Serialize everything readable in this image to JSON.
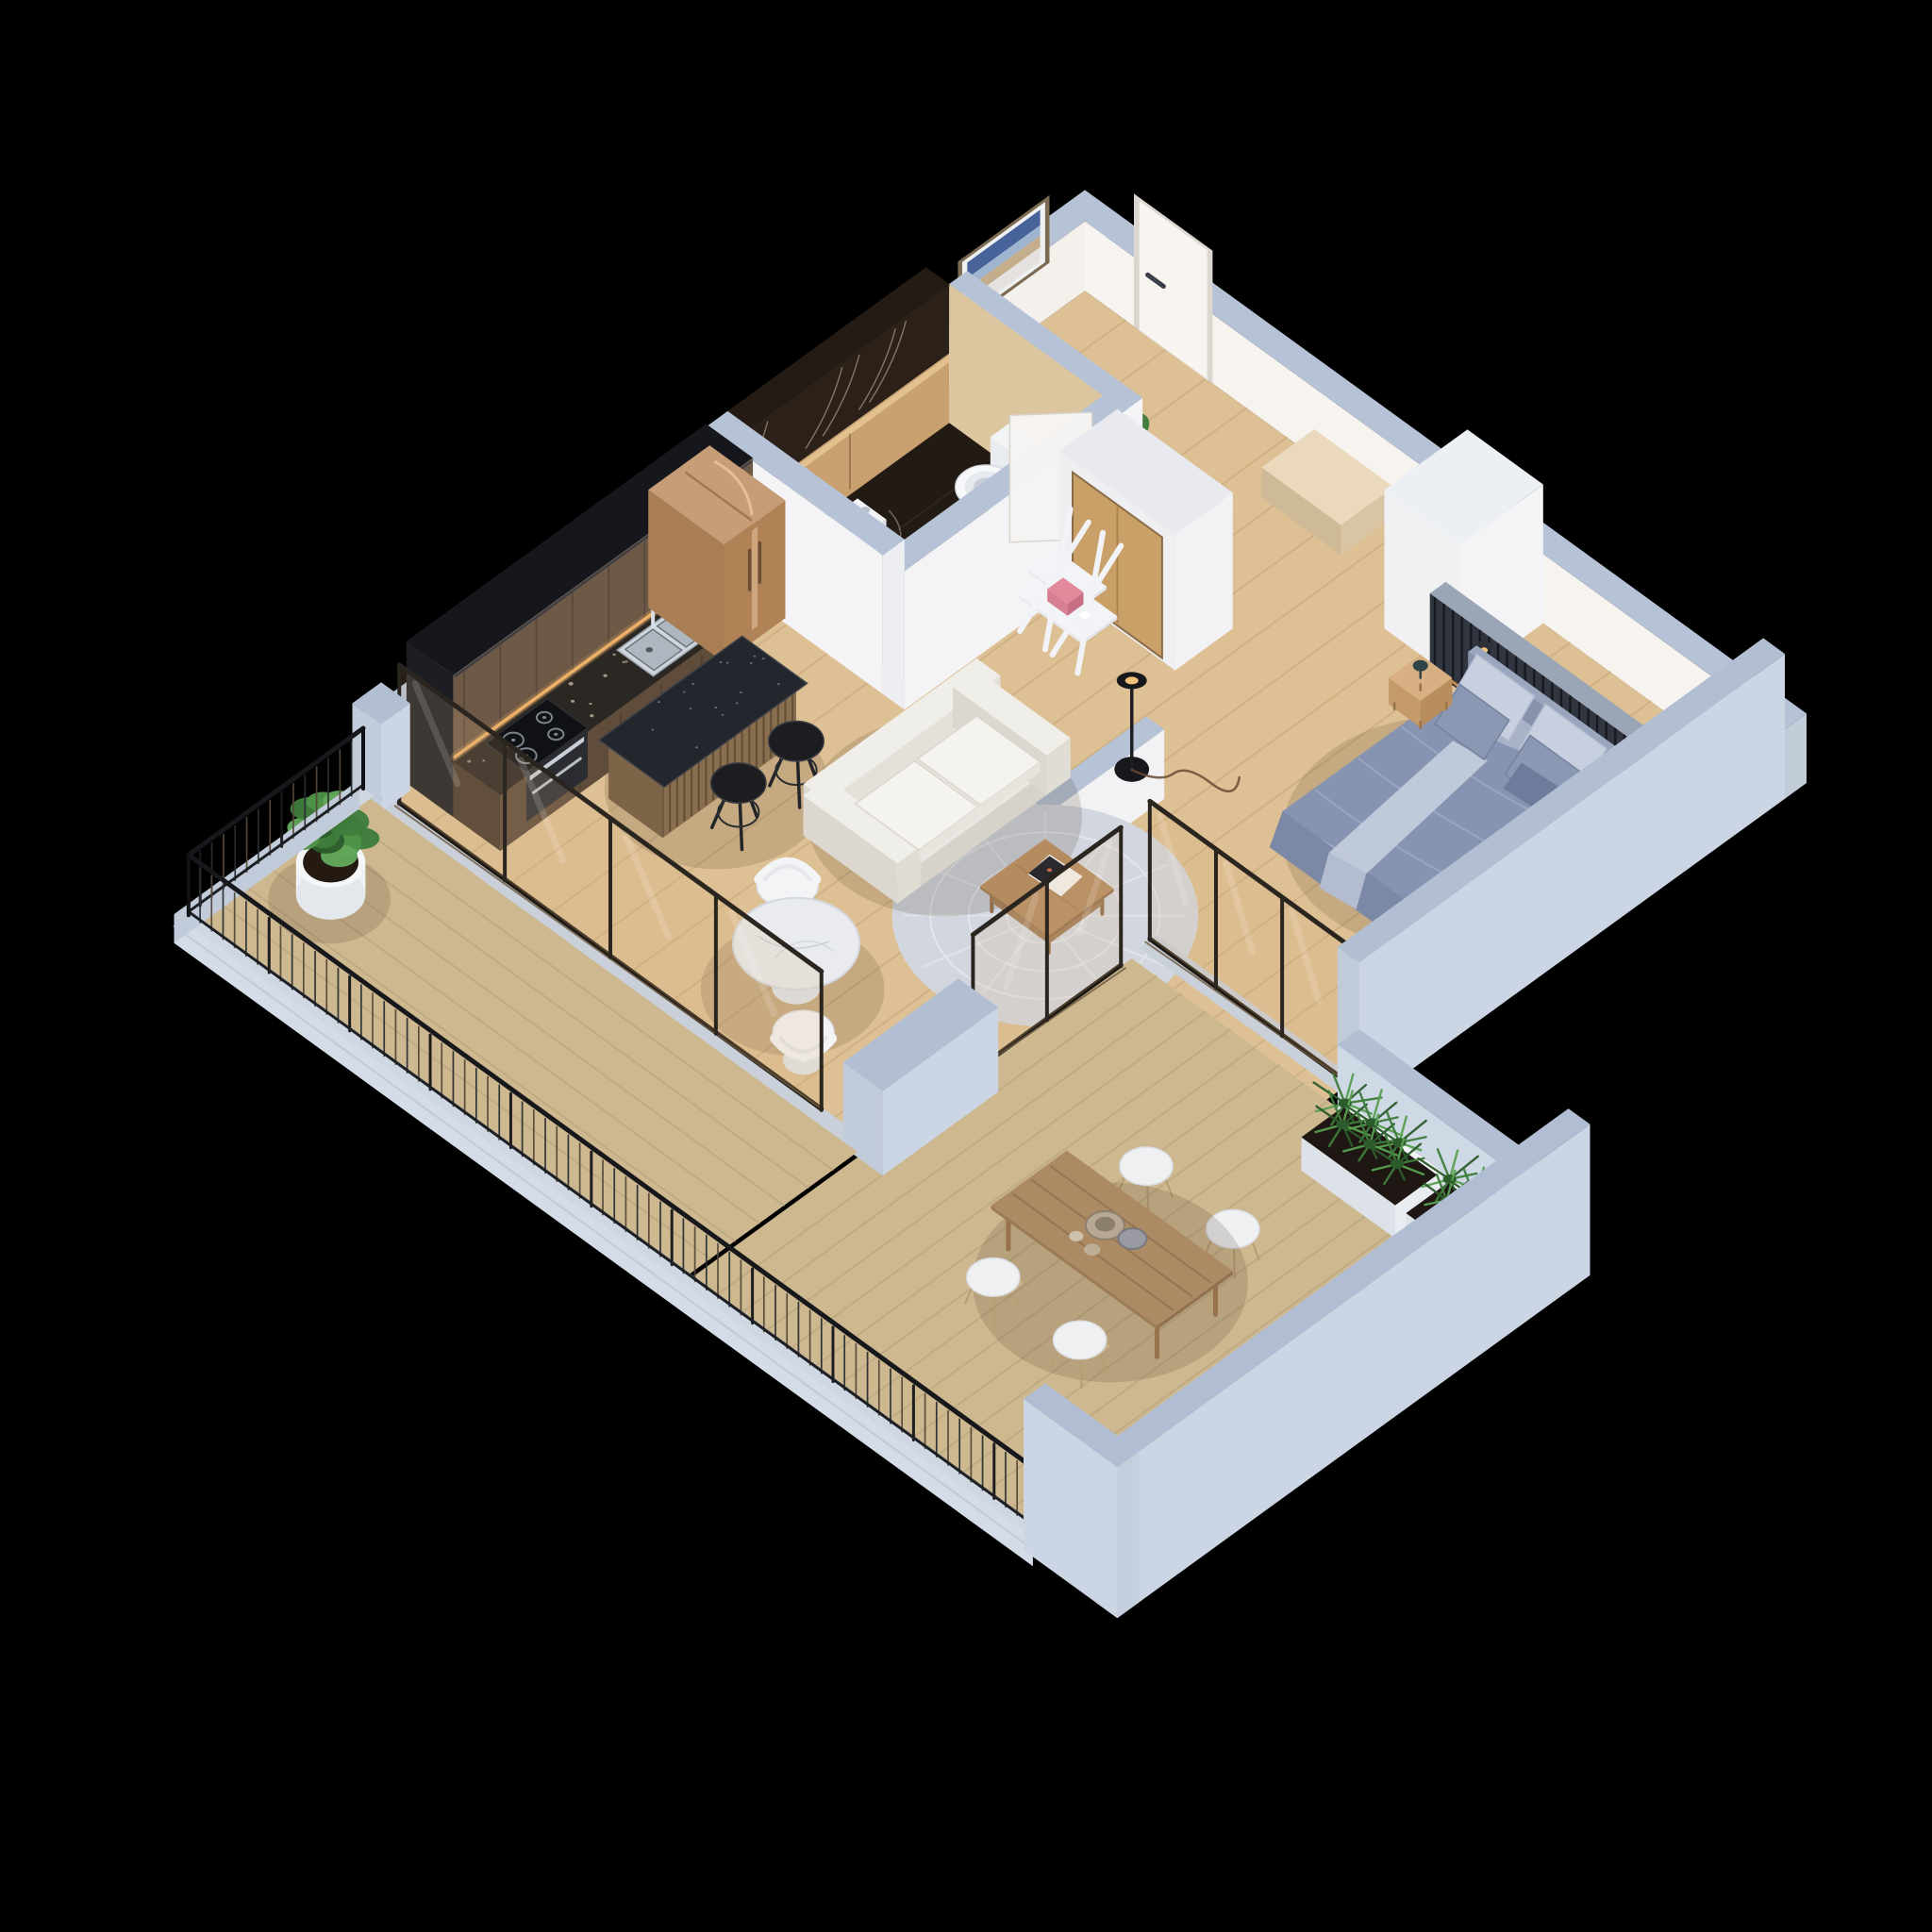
{
  "scene": {
    "title": "Isometric 3D floor plan render — one-bedroom apartment with wraparound balcony and terrace",
    "background": "#000000",
    "palette": {
      "concrete_cap": "#b6c2d6",
      "concrete_face": "#ccd5e3",
      "concrete_light": "#d4dce8",
      "wall_white": "#f4f3f5",
      "wall_warm": "#f6efe8",
      "wood_floor": "#ddc094",
      "wood_line": "#c4a678",
      "deck": "#cdb88f",
      "deck_line": "#b5a07a",
      "kitchen_tall": "#15171c",
      "kitchen_cabinet": "#6e5947",
      "counter": "#2b2722",
      "cooktop": "#101114",
      "steel": "#cfd6dd",
      "warm_light": "#f2b469",
      "fridge_bronze": "#c79d77",
      "island_top": "#23262c",
      "island_slat": "#8a6e50",
      "stool_black": "#1c1d21",
      "bath_marble": "#221b14",
      "bath_bronze": "#c9a070",
      "fixture_white": "#f7f8fa",
      "sofa_white": "#f4f2ee",
      "rug_gray": "#d2d7df",
      "bed_duvet": "#8794b1",
      "bed_pillow_light": "#c8cfde",
      "bed_frame": "#a9b2c6",
      "slat_wall": "#30353f",
      "marble_table": "#e9ebef",
      "coffee_table": "#b58c60",
      "terrace_table": "#ab8a64",
      "plant_green": "#3f7d3c",
      "plant_dark": "#2c5c2c",
      "plant_light": "#58a050",
      "railing_black": "#17181b",
      "glass_tint": "rgba(214,180,128,0.18)",
      "frame_bronze": "#2b251f"
    },
    "rooms": [
      "entry-hall",
      "bathroom",
      "kitchen",
      "living-room",
      "bedroom",
      "balcony",
      "terrace"
    ],
    "projection": {
      "ox": 1150,
      "oy": 275,
      "ux": 76.5,
      "uy": 55.5,
      "hz": 64
    },
    "items": [
      {
        "name": "nw-exterior-wall",
        "kind": "wallV",
        "u": 0,
        "v0": 0,
        "v1": 10,
        "t": 0.3,
        "h": 1.15,
        "cap": "#b6c2d6",
        "face": "#f4f1ed",
        "end": "#c3cdda"
      },
      {
        "name": "ne-exterior-wall",
        "kind": "wallU",
        "v": 0,
        "u0": 0.3,
        "u1": 10,
        "t": 0.3,
        "h": 1.15,
        "cap": "#b6c2d6",
        "face": "#f7f3ef",
        "end": "#c3cdda"
      },
      {
        "name": "interior-wood-floor",
        "kind": "floor",
        "u0": 0.3,
        "v0": 0.3,
        "u1": 9.7,
        "v1": 9.95,
        "fill": "#ddc094",
        "line": "#c4a678",
        "dir": "u",
        "gap": 0.56
      },
      {
        "name": "entry-bench",
        "kind": "box",
        "u0": 3.5,
        "v0": 0.32,
        "u1": 4.6,
        "v1": 1.05,
        "h": 0.5,
        "top": "#ead9bd",
        "fu": "#d9c5a4",
        "fv": "#cfba97"
      },
      {
        "name": "wall-artwork",
        "kind": "art",
        "u": 0.3,
        "v0": 0.85,
        "v1": 2.0,
        "h0": 0.95,
        "h1": 1.95
      },
      {
        "name": "entry-door",
        "kind": "doorNE",
        "u0": 1.05,
        "u1": 2.0,
        "v": 0.3,
        "h": 2.15,
        "fill": "#f8f5f1",
        "frame": "#dcd6d0",
        "handle": "#3a3f4a"
      },
      {
        "name": "hall-plant",
        "kind": "plantSquare",
        "u": 2.45,
        "v": 2.2
      },
      {
        "name": "bathroom-floor",
        "kind": "floor",
        "u0": 0.55,
        "v0": 2.5,
        "u1": 2.75,
        "v1": 5.25,
        "fill": "#221b14",
        "line": "#3a2f24",
        "dir": "u",
        "gap": 0.74,
        "veins": true
      },
      {
        "name": "bathroom-marble-wall",
        "kind": "bathSlab",
        "u0": 0.3,
        "u1": 0.62,
        "v0": 2.5,
        "v1": 5.25,
        "h": 2.3
      },
      {
        "name": "bathroom-hall-wall",
        "kind": "wallU",
        "v": 2.25,
        "u0": 0.62,
        "u1": 2.75,
        "t": 0.25,
        "h": 2.3,
        "cap": "#b6c2d6",
        "face": "#dcc6a0",
        "end": "#c3cdda"
      },
      {
        "name": "toilet",
        "kind": "toilet",
        "u": 1.75,
        "v": 3.0
      },
      {
        "name": "bidet",
        "kind": "bidet",
        "u": 1.15,
        "v": 4.35
      },
      {
        "name": "bathroom-se-wall",
        "kind": "wallV",
        "u": 2.75,
        "v0": 2.25,
        "v1": 5.55,
        "t": 0.3,
        "h": 2.3,
        "cap": "#b6c2d6",
        "face": "#f4f3f5",
        "end": "#eceef2"
      },
      {
        "name": "bathroom-sw-wall",
        "kind": "wallU",
        "v": 5.25,
        "u0": 0.3,
        "u1": 2.75,
        "t": 0.3,
        "h": 2.3,
        "cap": "#b6c2d6",
        "face": "#f4f3f5",
        "end": "#eceef2"
      },
      {
        "name": "bathroom-door",
        "kind": "bathDoor"
      },
      {
        "name": "storage-wall",
        "kind": "storage",
        "u0": 2.95,
        "v0": 2.5,
        "u1": 4.55,
        "v1": 3.3,
        "h": 2.25
      },
      {
        "name": "ladder-shelf",
        "kind": "ladder",
        "u": 3.1,
        "v": 3.5
      },
      {
        "name": "bedroom-wardrobe",
        "kind": "box",
        "u0": 5.6,
        "v0": 0.3,
        "u1": 6.65,
        "v1": 1.45,
        "h": 2.3,
        "top": "#eceff3",
        "fu": "#f4f4f6",
        "fv": "#f1f1f3"
      },
      {
        "name": "headboard-slat-wall",
        "kind": "slats",
        "u0": 6.3,
        "u1": 9.7,
        "v": 1.3,
        "t": 0.22,
        "h": 1.25
      },
      {
        "name": "kitchen-tall-cabinets",
        "kind": "tallKitchen",
        "u0": 0.3,
        "v0": 5.55,
        "u1": 0.95,
        "v1": 9.7,
        "h": 2.35
      },
      {
        "name": "kitchen-counter",
        "kind": "counter",
        "u0": 0.95,
        "v0": 6.35,
        "u1": 1.6,
        "v1": 9.7,
        "h": 0.92
      },
      {
        "name": "kitchen-sink",
        "kind": "sink",
        "u0": 1.02,
        "v0": 6.55,
        "u1": 1.52,
        "v1": 7.5,
        "h": 0.92
      },
      {
        "name": "cooktop-oven",
        "kind": "cooktop",
        "u0": 1.0,
        "v0": 8.45,
        "u1": 1.56,
        "v1": 9.3,
        "h": 0.92
      },
      {
        "name": "fridge",
        "kind": "fridge",
        "u0": 0.3,
        "v0": 5.5,
        "u1": 1.35,
        "v1": 6.35,
        "h": 1.95
      },
      {
        "name": "island-shadow",
        "kind": "shadow",
        "u": 2.5,
        "v": 7.6,
        "r": 1.1
      },
      {
        "name": "kitchen-island",
        "kind": "island",
        "u0": 1.85,
        "v0": 6.6,
        "u1": 2.6,
        "v1": 8.45,
        "h": 1.0
      },
      {
        "name": "bar-stool-1",
        "kind": "stool",
        "u": 3.05,
        "v": 7.05
      },
      {
        "name": "bar-stool-2",
        "kind": "stool",
        "u": 3.05,
        "v": 7.85
      },
      {
        "name": "partition-low-wall",
        "kind": "wallV",
        "u": 5.45,
        "v0": 4.6,
        "v1": 6.2,
        "t": 0.25,
        "h": 1.15,
        "cap": "#b6c2d6",
        "face": "#f2f2f4",
        "end": "#e8eaef"
      },
      {
        "name": "living-rug",
        "kind": "rug",
        "u": 6.0,
        "v": 6.55,
        "r": 1.5
      },
      {
        "name": "sofa-shadow",
        "kind": "shadow",
        "u": 4.35,
        "v": 6.3,
        "r": 1.35
      },
      {
        "name": "sofa",
        "kind": "sofa",
        "u0": 3.55,
        "v0": 5.05,
        "u1": 4.85,
        "v1": 7.45
      },
      {
        "name": "coffee-table",
        "kind": "ctable",
        "u0": 5.5,
        "v0": 6.05,
        "u1": 6.45,
        "v1": 6.95,
        "h": 0.42
      },
      {
        "name": "floor-lamp",
        "kind": "flamp",
        "u": 5.2,
        "v": 4.55
      },
      {
        "name": "bed-shadow",
        "kind": "shadow",
        "u": 8.0,
        "v": 3.0,
        "r": 1.6
      },
      {
        "name": "bed",
        "kind": "bed",
        "u0": 6.95,
        "v0": 1.52,
        "u1": 8.98,
        "v1": 4.25
      },
      {
        "name": "nightstand",
        "kind": "nstand",
        "u": 6.4,
        "v": 1.75
      },
      {
        "name": "dining-chair-tulip-1",
        "kind": "tulip",
        "u": 4.18,
        "v": 8.3,
        "back": "nw"
      },
      {
        "name": "round-table-shadow",
        "kind": "shadow",
        "u": 4.95,
        "v": 9.0,
        "r": 0.9
      },
      {
        "name": "round-marble-table",
        "kind": "rtable",
        "u": 4.95,
        "v": 8.95,
        "r": 0.62
      },
      {
        "name": "dining-chair-tulip-2",
        "kind": "tulip",
        "u": 5.7,
        "v": 9.6,
        "back": "se"
      },
      {
        "name": "bedroom-slider-sill",
        "kind": "floor",
        "u0": 6.95,
        "v0": 5.95,
        "u1": 9.7,
        "v1": 6.2,
        "fill": "#c9d0da"
      },
      {
        "name": "bedroom-terrace-slider",
        "kind": "slider",
        "a": [
          6.95,
          6.05
        ],
        "b": [
          9.7,
          6.05
        ],
        "h": 2.3,
        "panels": 3
      },
      {
        "name": "bedroom-se-wall",
        "kind": "wallV",
        "u": 9.7,
        "v0": 0.3,
        "v1": 6.2,
        "t": 0.3,
        "h": 2.4,
        "cap": "#b2bfd3",
        "face": "#ccd5e3",
        "end": "#c0cad9"
      },
      {
        "name": "terrace-deck",
        "kind": "floor",
        "u0": 7.0,
        "v0": 6.35,
        "u1": 13.0,
        "v1": 12.42,
        "fill": "#cdb88f",
        "line": "#b5a07a",
        "dir": "u",
        "gap": 0.34
      },
      {
        "name": "terrace-ne-parapet",
        "kind": "wallU",
        "v": 6.2,
        "u0": 10.0,
        "u1": 13.2,
        "t": 0.3,
        "h": 1.3,
        "cap": "#b2bfd3",
        "face": "#cfd8e5",
        "end": "#c0cad9"
      },
      {
        "name": "planter-box-1",
        "kind": "planter",
        "u0": 10.2,
        "v0": 6.55,
        "u1": 11.5,
        "v1": 7.2
      },
      {
        "name": "planter-box-2",
        "kind": "planter",
        "u0": 11.65,
        "v0": 6.55,
        "u1": 12.9,
        "v1": 7.2
      },
      {
        "name": "terrace-chair-1",
        "kind": "wire",
        "u": 9.35,
        "v": 8.5,
        "face": "sw"
      },
      {
        "name": "terrace-chair-2",
        "kind": "wire",
        "u": 10.55,
        "v": 8.5,
        "face": "sw"
      },
      {
        "name": "terrace-table-shadow",
        "kind": "shadow",
        "u": 9.95,
        "v": 9.6,
        "r": 1.35
      },
      {
        "name": "terrace-dining-table",
        "kind": "dtable",
        "u0": 8.8,
        "v0": 9.05,
        "u1": 11.1,
        "v1": 10.1,
        "h": 0.72
      },
      {
        "name": "terrace-chair-3",
        "kind": "wire",
        "u": 9.35,
        "v": 10.62,
        "face": "ne"
      },
      {
        "name": "terrace-chair-4",
        "kind": "wire",
        "u": 10.55,
        "v": 10.62,
        "face": "ne"
      },
      {
        "name": "living-terrace-slider",
        "kind": "slider",
        "a": [
          7.0,
          6.5
        ],
        "b": [
          7.0,
          8.55
        ],
        "h": 2.3,
        "panels": 2
      },
      {
        "name": "balcony-slider-sill",
        "kind": "floor",
        "u0": 0.3,
        "v0": 9.92,
        "u1": 6.9,
        "v1": 10.12,
        "fill": "#c9d0da"
      },
      {
        "name": "living-balcony-slider",
        "kind": "slider",
        "a": [
          0.45,
          9.95
        ],
        "b": [
          6.3,
          9.95
        ],
        "h": 2.3,
        "panels": 4
      },
      {
        "name": "concrete-pier-nw",
        "kind": "box",
        "u0": 0.0,
        "v0": 9.75,
        "u1": 0.4,
        "v1": 10.15,
        "h": 1.45,
        "top": "#b2bfd3",
        "fu": "#ccd5e3",
        "fv": "#c2cbda"
      },
      {
        "name": "concrete-pier-mid",
        "kind": "box",
        "u0": 6.8,
        "v0": 8.55,
        "u1": 7.35,
        "v1": 10.15,
        "h": 1.4,
        "top": "#b2bfd3",
        "fu": "#ccd5e3",
        "fv": "#c2cbda"
      },
      {
        "name": "balcony-deck",
        "kind": "floor",
        "u0": 0.05,
        "v0": 10.1,
        "u1": 6.95,
        "v1": 12.42,
        "fill": "#cdb88f",
        "line": "#b5a07a",
        "dir": "v",
        "gap": 0.34
      },
      {
        "name": "balcony-plant-shadow",
        "kind": "shadow",
        "u": 0.88,
        "v": 11.35,
        "r": 0.6
      },
      {
        "name": "balcony-potted-plant",
        "kind": "potPlant",
        "u": 0.85,
        "v": 11.3
      },
      {
        "name": "balcony-curb-sw",
        "kind": "floor",
        "u0": 0.0,
        "v0": 12.42,
        "u1": 11.9,
        "v1": 12.62,
        "fill": "#cfd7e2"
      },
      {
        "name": "balcony-curb-nw",
        "kind": "floor",
        "u0": 0.0,
        "v0": 10.05,
        "u1": 0.2,
        "v1": 12.62,
        "fill": "#cfd7e2"
      },
      {
        "name": "slab-fascia",
        "kind": "fascia"
      },
      {
        "name": "balcony-terrace-railing",
        "kind": "railing",
        "pts": [
          [
            0.1,
            10.1
          ],
          [
            0.1,
            12.52
          ],
          [
            11.9,
            12.52
          ]
        ],
        "h": 1.08
      },
      {
        "name": "terrace-se-wall",
        "kind": "wallV",
        "u": 12.9,
        "v0": 6.2,
        "v1": 12.75,
        "t": 0.3,
        "h": 2.5,
        "cap": "#b0bdd2",
        "face": "#ccd5e3",
        "end": "#c4cedd"
      },
      {
        "name": "terrace-sw-return-wall",
        "kind": "wallU",
        "v": 12.45,
        "u0": 11.9,
        "u1": 13.2,
        "t": 0.3,
        "h": 2.5,
        "cap": "#b0bdd2",
        "face": "#ccd5e3",
        "end": "#c4cedd"
      }
    ]
  }
}
